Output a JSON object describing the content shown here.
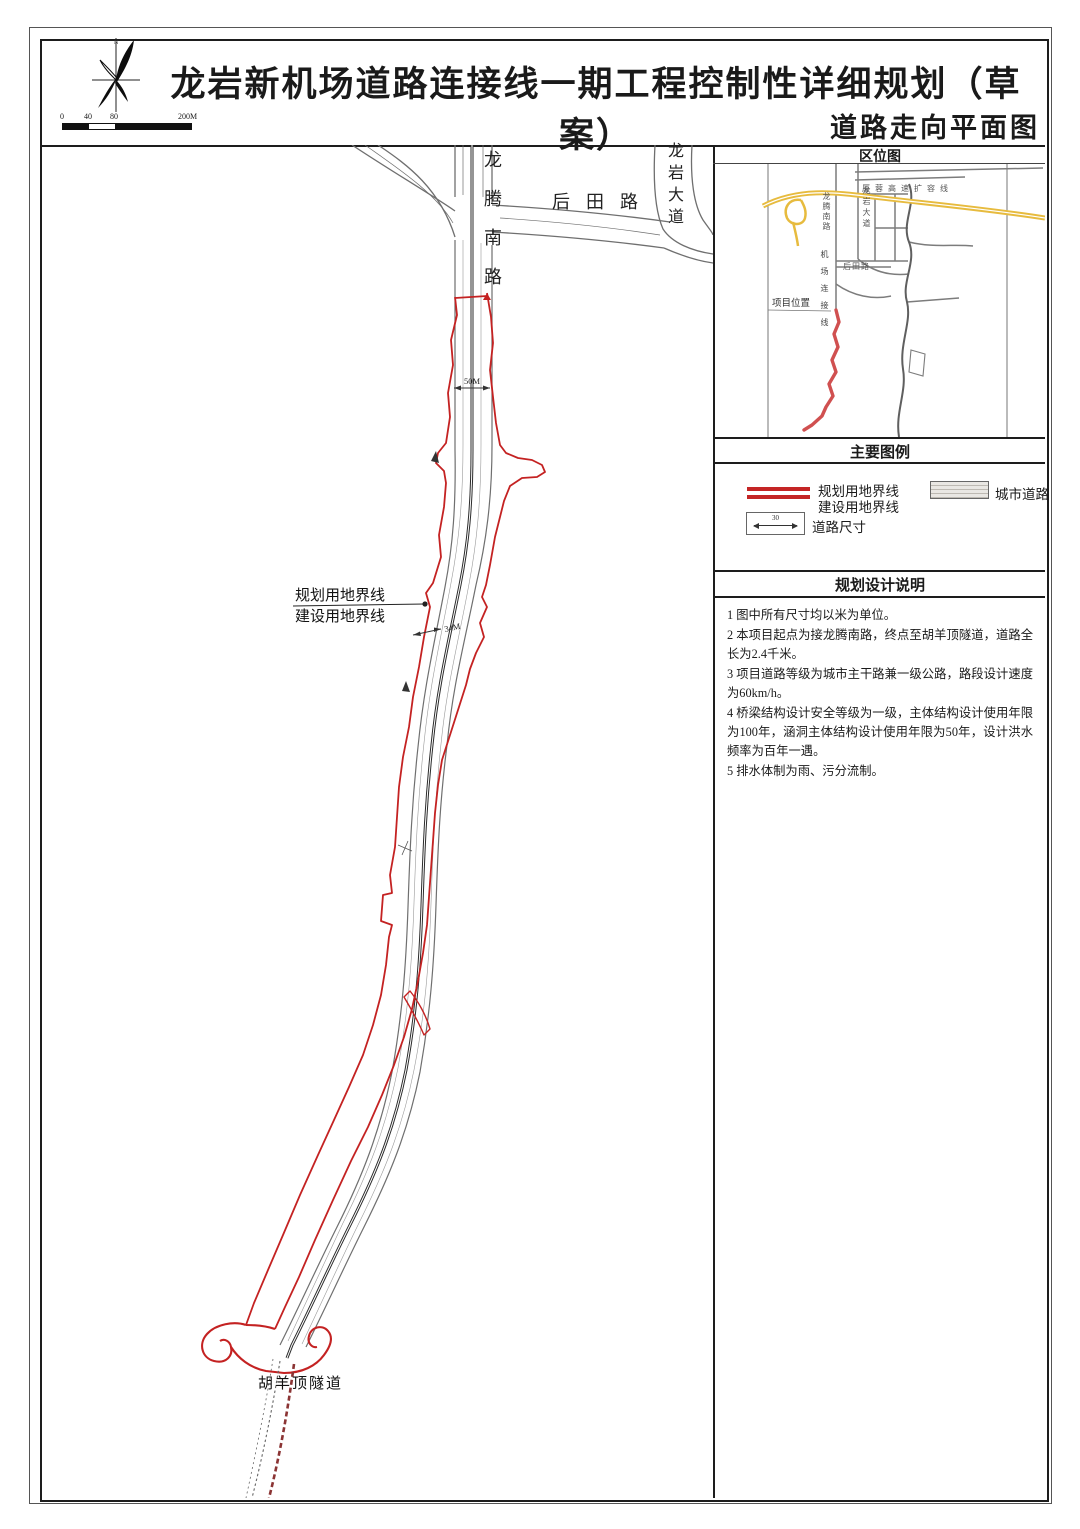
{
  "title": {
    "main": "龙岩新机场道路连接线一期工程控制性详细规划（草案）",
    "sub": "道路走向平面图"
  },
  "compass": {
    "north_label": "N"
  },
  "scale_bar": {
    "labels": [
      "0",
      "40",
      "80",
      "200M"
    ]
  },
  "main_map": {
    "road_labels": {
      "longteng_nanlu": "龙腾南路",
      "houtian_road": "后田路",
      "longyan_avenue": "龙岩大道"
    },
    "dimensions": {
      "d50": "50M",
      "d34": "34M"
    },
    "boundary_label_line1": "规划用地界线",
    "boundary_label_line2": "建设用地界线",
    "tunnel_label": "胡羊顶隧道"
  },
  "location_map": {
    "header": "区位图",
    "labels": {
      "expressway": "厦蓉高速扩容线",
      "longteng_nanlu": "龙腾南路",
      "longyan_avenue": "龙岩大道",
      "houtian_road": "后田路",
      "airport_link": "机场连接线",
      "project_location": "项目位置"
    }
  },
  "legend": {
    "header": "主要图例",
    "planning_boundary_label": "规划用地界线",
    "construction_boundary_label": "建设用地界线",
    "city_road_label": "城市道路",
    "road_dim_label": "道路尺寸",
    "road_dim_value": "30"
  },
  "notes": {
    "header": "规划设计说明",
    "items": [
      "1 图中所有尺寸均以米为单位。",
      "2 本项目起点为接龙腾南路，终点至胡羊顶隧道，道路全长为2.4千米。",
      "3 项目道路等级为城市主干路兼一级公路，路段设计速度为60km/h。",
      "4 桥梁结构设计安全等级为一级，主体结构设计使用年限为100年，涵洞主体结构设计使用年限为50年，设计洪水频率为百年一遇。",
      "5 排水体制为雨、污分流制。"
    ]
  },
  "colors": {
    "boundary_red": "#c42222",
    "location_route_red": "#d05050",
    "highway_yellow": "#e7bb3e",
    "road_gray": "#787878",
    "tunnel_dash_red": "#8b3434",
    "ink": "#1d1d1d"
  }
}
